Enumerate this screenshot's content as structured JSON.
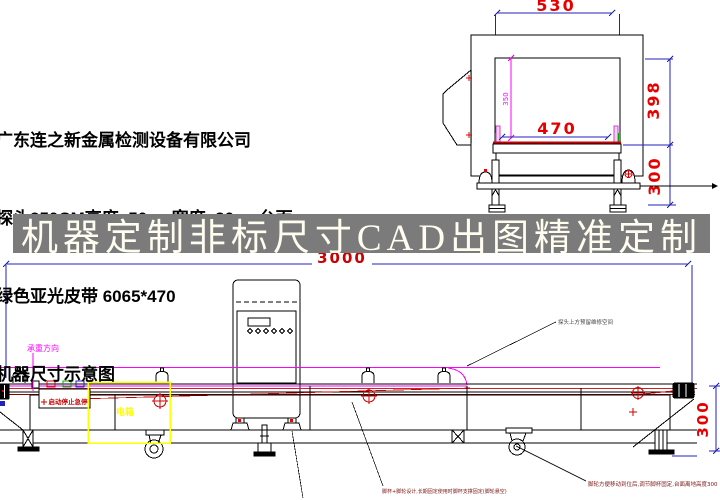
{
  "company": {
    "name": "广东连之新金属检测设备有限公司",
    "spec": "探头350CM高度  50cm宽度  30cm台面",
    "belt": "绿色亚光皮带 6065*470",
    "caption": "机器尺寸示意图"
  },
  "banner": {
    "text": "机器定制非标尺寸CAD出图精准定制"
  },
  "front_view": {
    "dim_top_width": "530",
    "dim_belt_width": "470",
    "dim_upper_height": "398",
    "dim_lower_height": "300",
    "dim_tunnel_height": "350"
  },
  "side_view": {
    "dim_total_length": "3000",
    "dim_table_height": "300",
    "load_direction_label": "承重方向",
    "control_buttons_label": "启动停止急停",
    "electric_box_label": "电箱",
    "probe_note": "探头上方预留维修空间",
    "foot_note_left": "脚杯+脚轮设计,长期固定使用时脚杯支撑固定(脚轮悬空)",
    "foot_note_right": "脚轮方便移动到位后,调节脚杯固定,台面离地高度300"
  },
  "colors": {
    "dim_red": "#e60000",
    "dark_red": "#aa0000",
    "note_red": "#7a1515",
    "dim_blue": "#2222bb",
    "magenta": "#ff00ff",
    "green": "#00aa00",
    "yellow": "#ffff00",
    "banner_bg": "#7b7b7b",
    "banner_fg": "#fffdf0"
  }
}
